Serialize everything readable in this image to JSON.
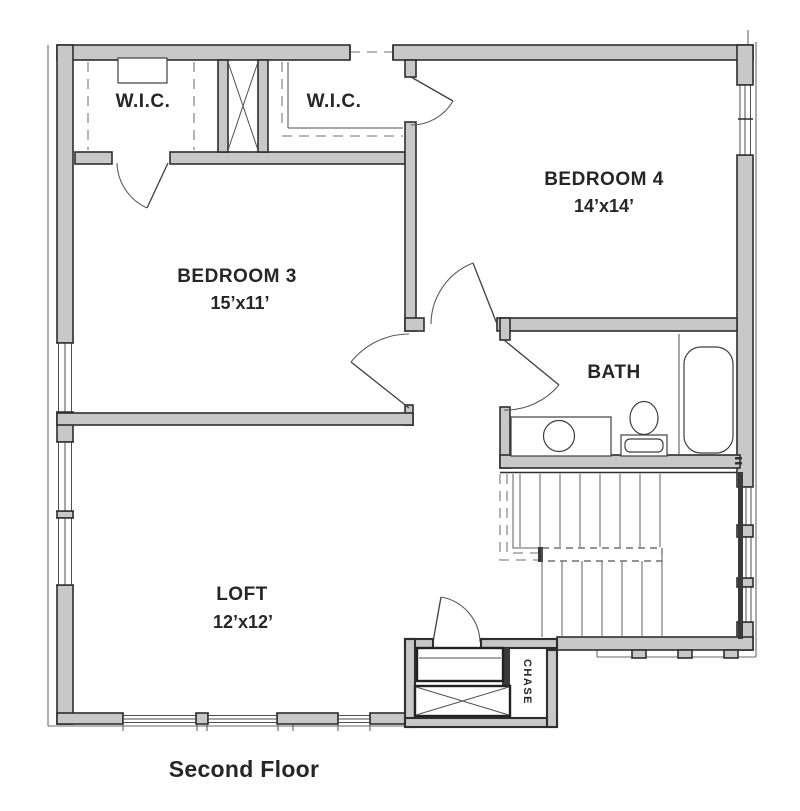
{
  "colors": {
    "wall_fill": "#c8c8c8",
    "wall_stroke": "#2e2e2e",
    "line_thin": "#4f4f4f",
    "line_veneer": "#6a6a6a",
    "line_dash": "#8c8c8c",
    "line_door": "#5a5a5a",
    "line_fixture": "#3f3f3f",
    "line_tread": "#5f5f5f",
    "text_color": "#262626"
  },
  "floor_plan": {
    "caption": "Second Floor",
    "rooms": {
      "wic1": {
        "label": "W.I.C."
      },
      "wic2": {
        "label": "W.I.C."
      },
      "bedroom4": {
        "label": "BEDROOM 4",
        "dims": "14’x14’"
      },
      "bedroom3": {
        "label": "BEDROOM 3",
        "dims": "15’x11’"
      },
      "bath": {
        "label": "BATH"
      },
      "loft": {
        "label": "LOFT",
        "dims": "12’x12’"
      },
      "chase": {
        "label": "CHASE"
      }
    }
  }
}
